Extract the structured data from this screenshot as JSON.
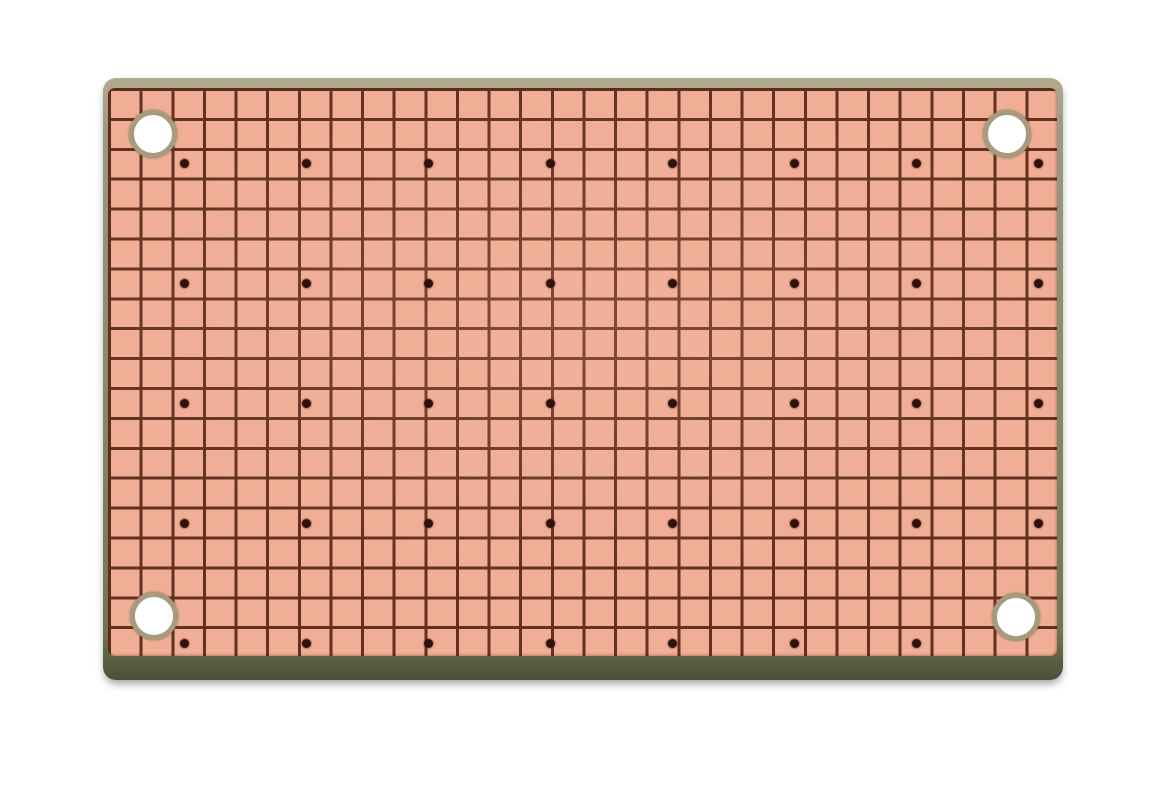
{
  "scene": {
    "description": "photo of a blank copper-clad prototyping perfboard on a plain white background",
    "background_color": "#ffffff"
  },
  "board": {
    "x": 103,
    "y": 78,
    "width": 960,
    "height": 602,
    "corner_radius": 13,
    "substrate_edge_colors": {
      "top_tan": "#b2ab91",
      "mid_tan": "#9d9880",
      "side_olive": "#868867",
      "bottom_olive": "#71754f",
      "bottom_dark_line": "#4b503a"
    },
    "drop_shadow": "0 5px 8px -1px rgba(95, 95, 95, 0.55)"
  },
  "copper": {
    "inset_left": 5,
    "inset_top": 10,
    "width": 949,
    "height": 568,
    "pad_color": "#f0ae97",
    "pad_highlight": "#f4b9a2",
    "grid_line_color": "#64301f",
    "grid_line_width": 3,
    "grid_pitch_x": 31.63,
    "grid_pitch_y": 29.9,
    "columns": 30,
    "rows": 19
  },
  "drill_dots": {
    "color": "#2e130b",
    "diameter": 9,
    "start_x": 184,
    "start_y": 163,
    "pitch_x": 122,
    "pitch_y": 120,
    "columns": 8,
    "rows": 5,
    "omitted_cells": [
      [
        7,
        4
      ]
    ]
  },
  "mounting_holes": {
    "hole_color": "#ffffff",
    "ring_color": "#a69c7d",
    "inner_diameter": 38,
    "ring_width": 5,
    "positions": [
      {
        "x": 153,
        "y": 134
      },
      {
        "x": 1007,
        "y": 134
      },
      {
        "x": 154,
        "y": 616
      },
      {
        "x": 1016,
        "y": 617
      }
    ]
  }
}
